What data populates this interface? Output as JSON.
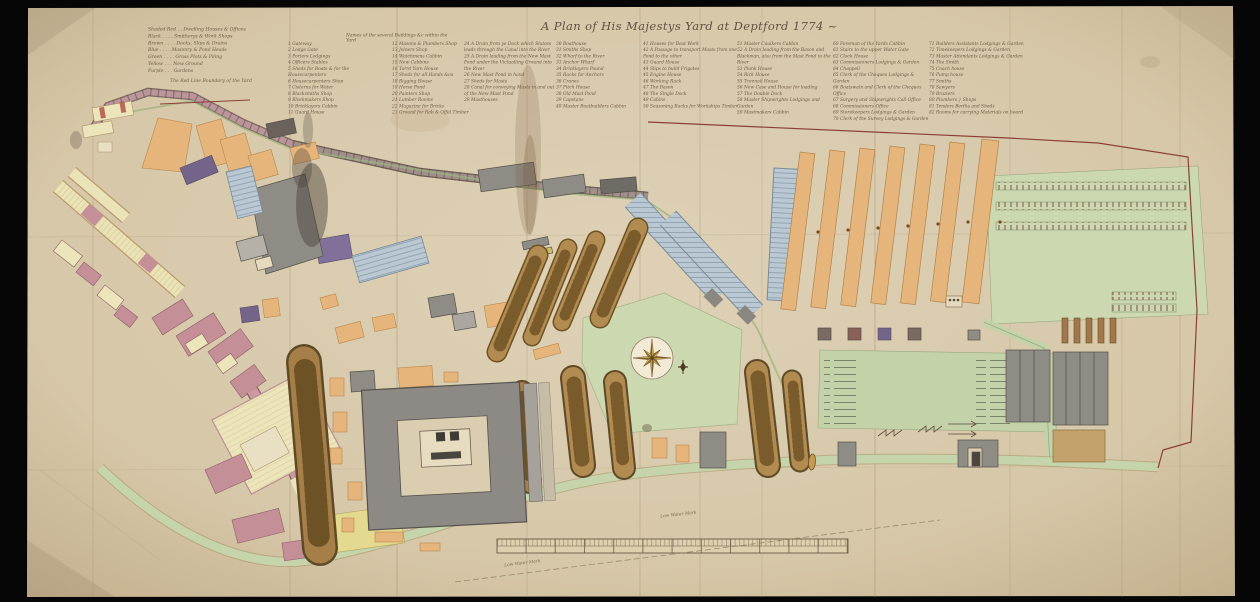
{
  "title": "A Plan of His Majestys Yard at Deptford 1774 ~",
  "color_key": {
    "items": [
      "Shaded Red . . Dwelling Houses & Offices",
      "Black . . . . Smitherys & Work Shops",
      "Brown . . . . Docks, Slips & Drains",
      "Blue . . . . Masonry & Pond Heads",
      "Green . . . . Grass Plots & Piling",
      "Yellow . . . New Ground",
      "Purple . . . Gardens"
    ],
    "boundary_note": "The Red Line Boundary of the Yard"
  },
  "legend": {
    "header": "Names of the several Buildings &c within the Yard",
    "columns": [
      {
        "items": [
          "1 Gateway",
          "2 Lodge Gate",
          "3 Porters Lodgings",
          "4 Officers Stables",
          "5 Sheds for Boats & for the Housecarpenters",
          "6 Housecarpenters Shop",
          "7 Cisterns for Water",
          "8 Blacksmiths Shop",
          "9 Blockmakers Shop",
          "10 Bricklayers Cabbin",
          "11 Guard House"
        ]
      },
      {
        "items": [
          "12 Masons & Plumbers Shop",
          "13 Joiners Shop",
          "14 Watchmens Cabbin",
          "15 New Cabbins",
          "16 Tarrd Yarn House",
          "17 Sheds for all Hands &ca",
          "18 Rigging House",
          "19 Horse Pond",
          "20 Painters Shop",
          "21 Lumber Rooms",
          "22 Magazine for Bricks",
          "23 Ground for Rob & Offal Timber"
        ]
      },
      {
        "items": [
          "24 A Drain from ye Dock which Sluices leads through the Canal into the River",
          "25 A Drain leading from the New Mast Pond under the Victualling Ground into the River",
          "26 New Mast Pond in hand",
          "27 Sheds for Masts",
          "28 Canal for conveying Masts in and out of the New Mast Pond",
          "29 Masthouses"
        ]
      },
      {
        "items": [
          "30 Boathouse",
          "31 Smiths Shop",
          "32 Wharf to the River",
          "33 Anchor Wharf",
          "34 Bricklayers Pound",
          "35 Racks for Anchors",
          "36 Cranes",
          "37 Pitch House",
          "38 Old Mast Pond",
          "39 Capstans",
          "40 Master Boatbuilders Cabbin"
        ]
      },
      {
        "items": [
          "41 Houses for Boat Work",
          "42 A Passage to transport Masts from one Pond to the other",
          "43 Guard House",
          "44 Slips to build Frigates",
          "45 Engine House",
          "46 Working Rack",
          "47 The Bason",
          "48 The Single Dock",
          "49 Cabins",
          "50 Seasoning Racks for Workships Timber"
        ]
      },
      {
        "items": [
          "51 Master Caulkers Cabbin",
          "52 A Drain leading from the Bason and Blackman, also from the Mast Pond to the River",
          "53 Plank House",
          "54 Rick House",
          "55 Treenail House",
          "56 New Case and House for loading",
          "57 The Double Dock",
          "58 Master Shipwrights Lodgings and Garden",
          "59 Mastmakers Cabbin"
        ]
      },
      {
        "items": [
          "60 Foreman of the Yards Cabbin",
          "61 Stairs to the upper Water Gate",
          "62 Clock House",
          "63 Commissioners Lodgings & Garden",
          "64 Chappell",
          "65 Clerk of the Cheques Lodgings & Garden",
          "66 Boatswain and Clerk of the Cheques Office",
          "67 Surgery and Shipwrights Call Office",
          "68 Commissioners Office",
          "69 Storekeepers Lodgings & Garden",
          "70 Clerk of the Survey Lodgings & Garden"
        ]
      },
      {
        "items": [
          "71 Builders Assistants Lodgings & Garden",
          "72 Timekeepers Lodgings & Garden",
          "73 Master Attendants Lodgings & Garden",
          "74 The Smith",
          "75 Coach house",
          "76 Pump house",
          "77 Smiths",
          "78 Sawyers",
          "79 Braziers",
          "80 Plumbers   } Shops",
          "81 Tenders Berths and Sheds",
          "82 Rooms for carrying Materials on board"
        ]
      }
    ]
  },
  "labels": {
    "low_water_mark": "Low Water Mark",
    "low_water_mark_2": "Low Water Mark"
  },
  "palette": {
    "parchment": "#d8c9ab",
    "ink": "#6b5a42",
    "boundary_red": "#8a4038",
    "orange": "#e6b57c",
    "gray": "#8f8b85",
    "blue_dock": "#b9c8d3",
    "pink": "#c48f97",
    "purple": "#74648a",
    "yellow": "#ece4bb",
    "green": "#ccd8b0",
    "brown_slip": "#b28b50",
    "compass_gold": "#d9b35a"
  }
}
